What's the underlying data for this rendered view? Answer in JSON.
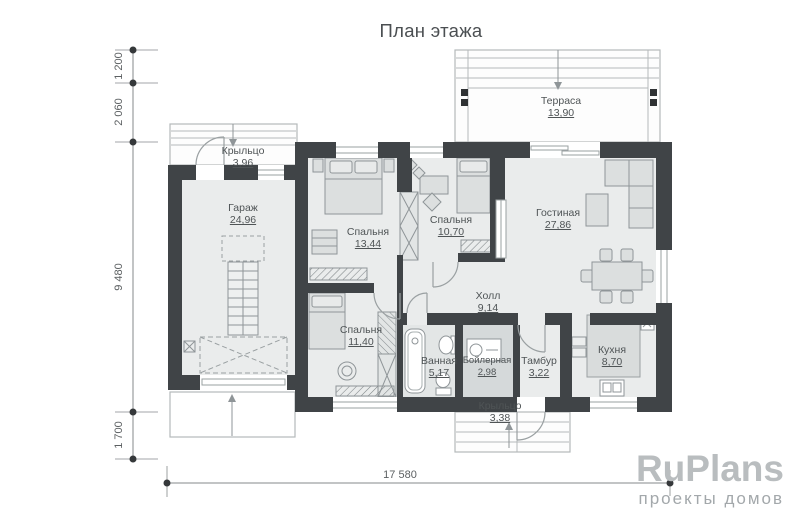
{
  "title": "План этажа",
  "rooms": {
    "porch_top": {
      "name": "Крыльцо",
      "area": "3,96"
    },
    "garage": {
      "name": "Гараж",
      "area": "24,96"
    },
    "bedroom1": {
      "name": "Спальня",
      "area": "13,44"
    },
    "bedroom2": {
      "name": "Спальня",
      "area": "10,70"
    },
    "living": {
      "name": "Гостиная",
      "area": "27,86"
    },
    "terrace": {
      "name": "Терраса",
      "area": "13,90"
    },
    "hall": {
      "name": "Холл",
      "area": "9,14"
    },
    "bedroom3": {
      "name": "Спальня",
      "area": "11,40"
    },
    "bathroom": {
      "name": "Ванная",
      "area": "5,17"
    },
    "boiler": {
      "name": "Бойлерная",
      "area": "2,98"
    },
    "tambour": {
      "name": "Тамбур",
      "area": "3,22"
    },
    "kitchen": {
      "name": "Кухня",
      "area": "8,70"
    },
    "porch_bottom": {
      "name": "Крыльцо",
      "area": "3,38"
    }
  },
  "dimensions": {
    "left_top": "1 200",
    "left_upper": "2 060",
    "left_main": "9 480",
    "left_bottom": "1 700",
    "bottom_total": "17 580"
  },
  "logo": {
    "brand": "RuPlans",
    "tagline": "проекты домов"
  },
  "colors": {
    "wall": "#404447",
    "floor": "#eaecec",
    "furniture": "#dcdfdf",
    "boiler_floor": "#d5d9da",
    "text": "#4f5456",
    "logo": "#b9bdbf"
  }
}
